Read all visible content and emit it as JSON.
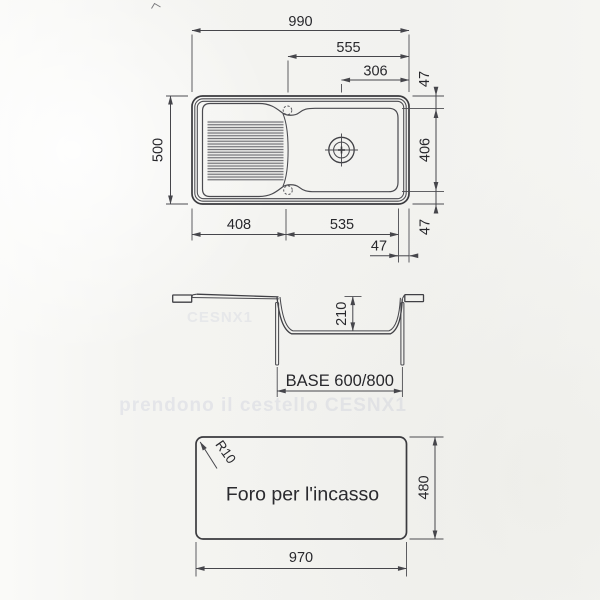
{
  "drawing": {
    "plan": {
      "overall_width": "990",
      "bowl_span": "555",
      "drain_offset": "306",
      "overall_depth": "500",
      "rim_top_47": "47",
      "basin_depth_406": "406",
      "rim_bottom_47": "47",
      "drainer_width": "408",
      "bowl_width": "535",
      "rim_right_47": "47"
    },
    "section": {
      "bowl_depth": "210",
      "base_label": "BASE 600/800"
    },
    "cutout": {
      "corner_radius": "R10",
      "caption": "Foro per l'incasso",
      "height": "480",
      "width": "970"
    },
    "bleedthrough": {
      "line1": "CESNX1",
      "line2": "prendono il cestello CESNX1"
    },
    "colors": {
      "line": "#3a3a3e",
      "text": "#28282c",
      "background": "#f4f4f1"
    }
  }
}
